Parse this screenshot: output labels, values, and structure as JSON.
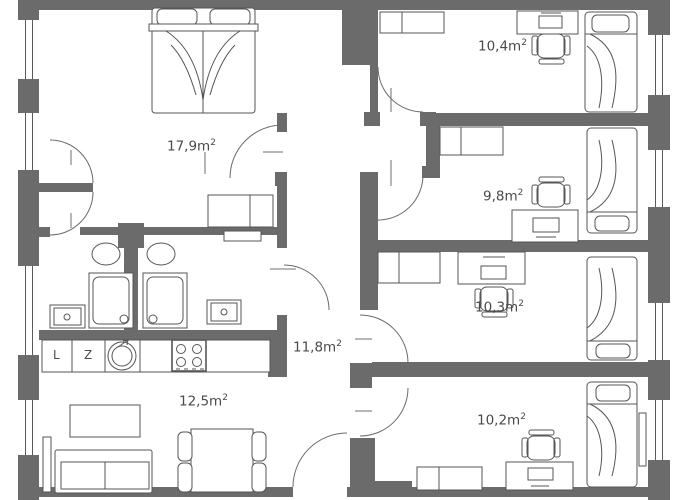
{
  "plan_title": "apartment-floor-plan",
  "rooms": [
    {
      "name": "bedroom-large",
      "area": "17,9m",
      "sup": "2"
    },
    {
      "name": "room-top-right",
      "area": "10,4m",
      "sup": "2"
    },
    {
      "name": "room-mid-right",
      "area": "9,8m",
      "sup": "2"
    },
    {
      "name": "room-lower-right",
      "area": "10,3m",
      "sup": "2"
    },
    {
      "name": "hallway",
      "area": "11,8m",
      "sup": "2"
    },
    {
      "name": "living-kitchen",
      "area": "12,5m",
      "sup": "2"
    },
    {
      "name": "room-bottom-right",
      "area": "10,2m",
      "sup": "2"
    }
  ],
  "kitchen": {
    "fridge_label": "L",
    "dishwasher_label": "Z"
  },
  "colors": {
    "wall": "#6b6b6b",
    "line": "#565656",
    "text": "#4a4a4a",
    "background": "#ffffff"
  }
}
